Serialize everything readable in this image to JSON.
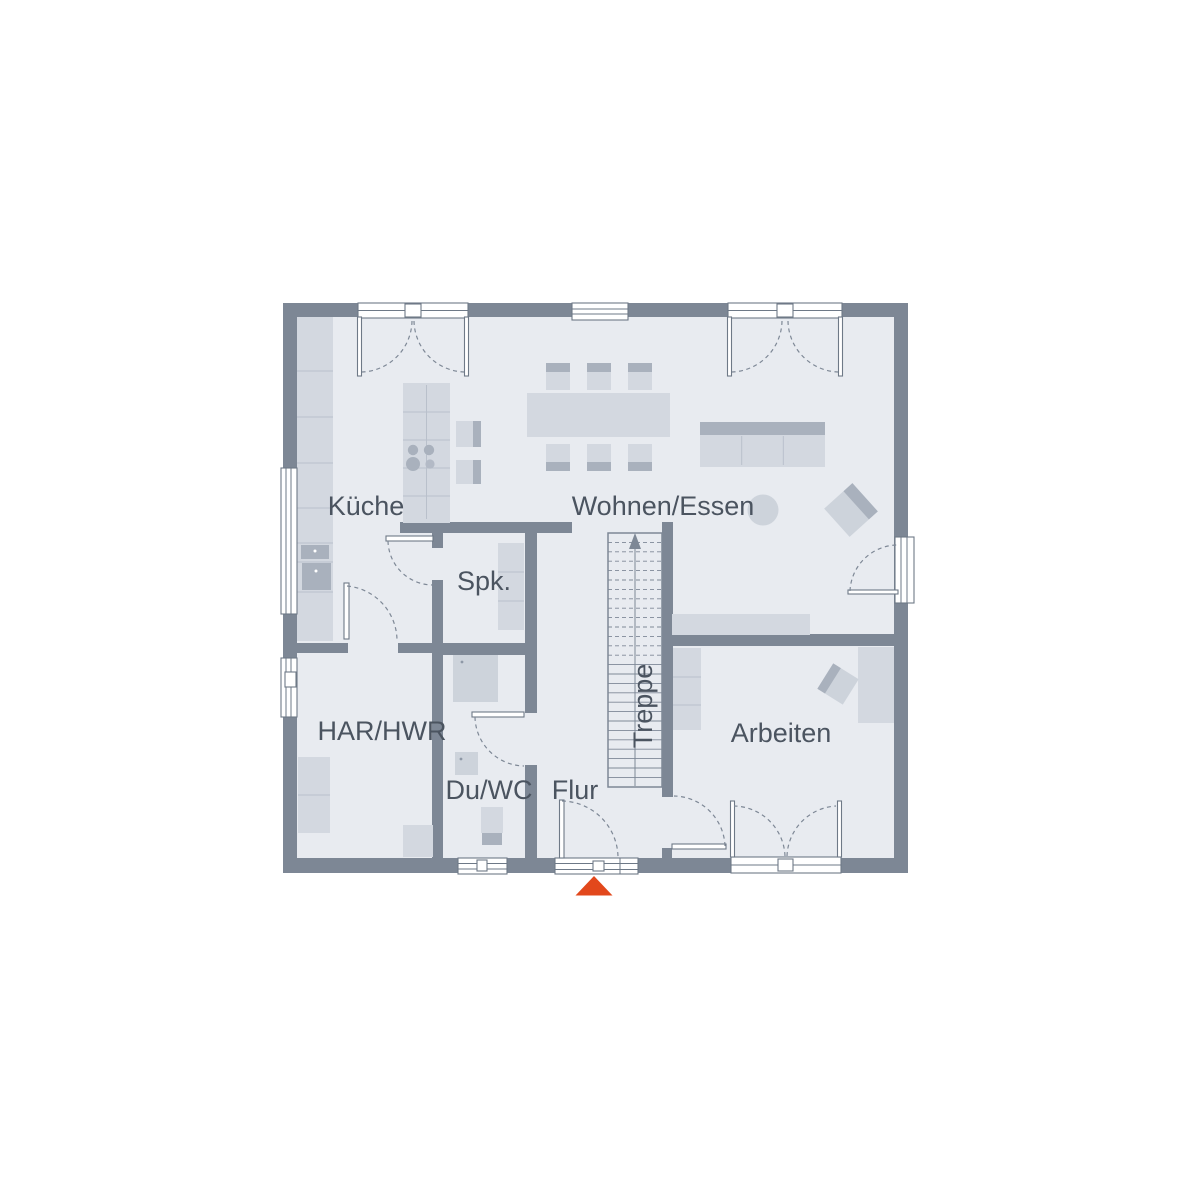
{
  "floorplan": {
    "labels": {
      "kitchen": "Küche",
      "living_dining": "Wohnen/Essen",
      "pantry": "Spk.",
      "utility": "HAR/HWR",
      "shower_wc": "Du/WC",
      "hallway": "Flur",
      "stairs": "Treppe",
      "office": "Arbeiten"
    },
    "colors": {
      "wall": "#7d8795",
      "floor": "#e8ebf0",
      "furniture": "#d3d8e0",
      "furniture_accent": "#a9b1bd",
      "furniture_mid": "#cdd3db",
      "outline": "#6e7987",
      "swing_line": "#7e8896",
      "furniture_line": "#b9c0cb",
      "text": "#4b5460",
      "entrance_marker": "#e2481c",
      "background": "#ffffff"
    }
  }
}
